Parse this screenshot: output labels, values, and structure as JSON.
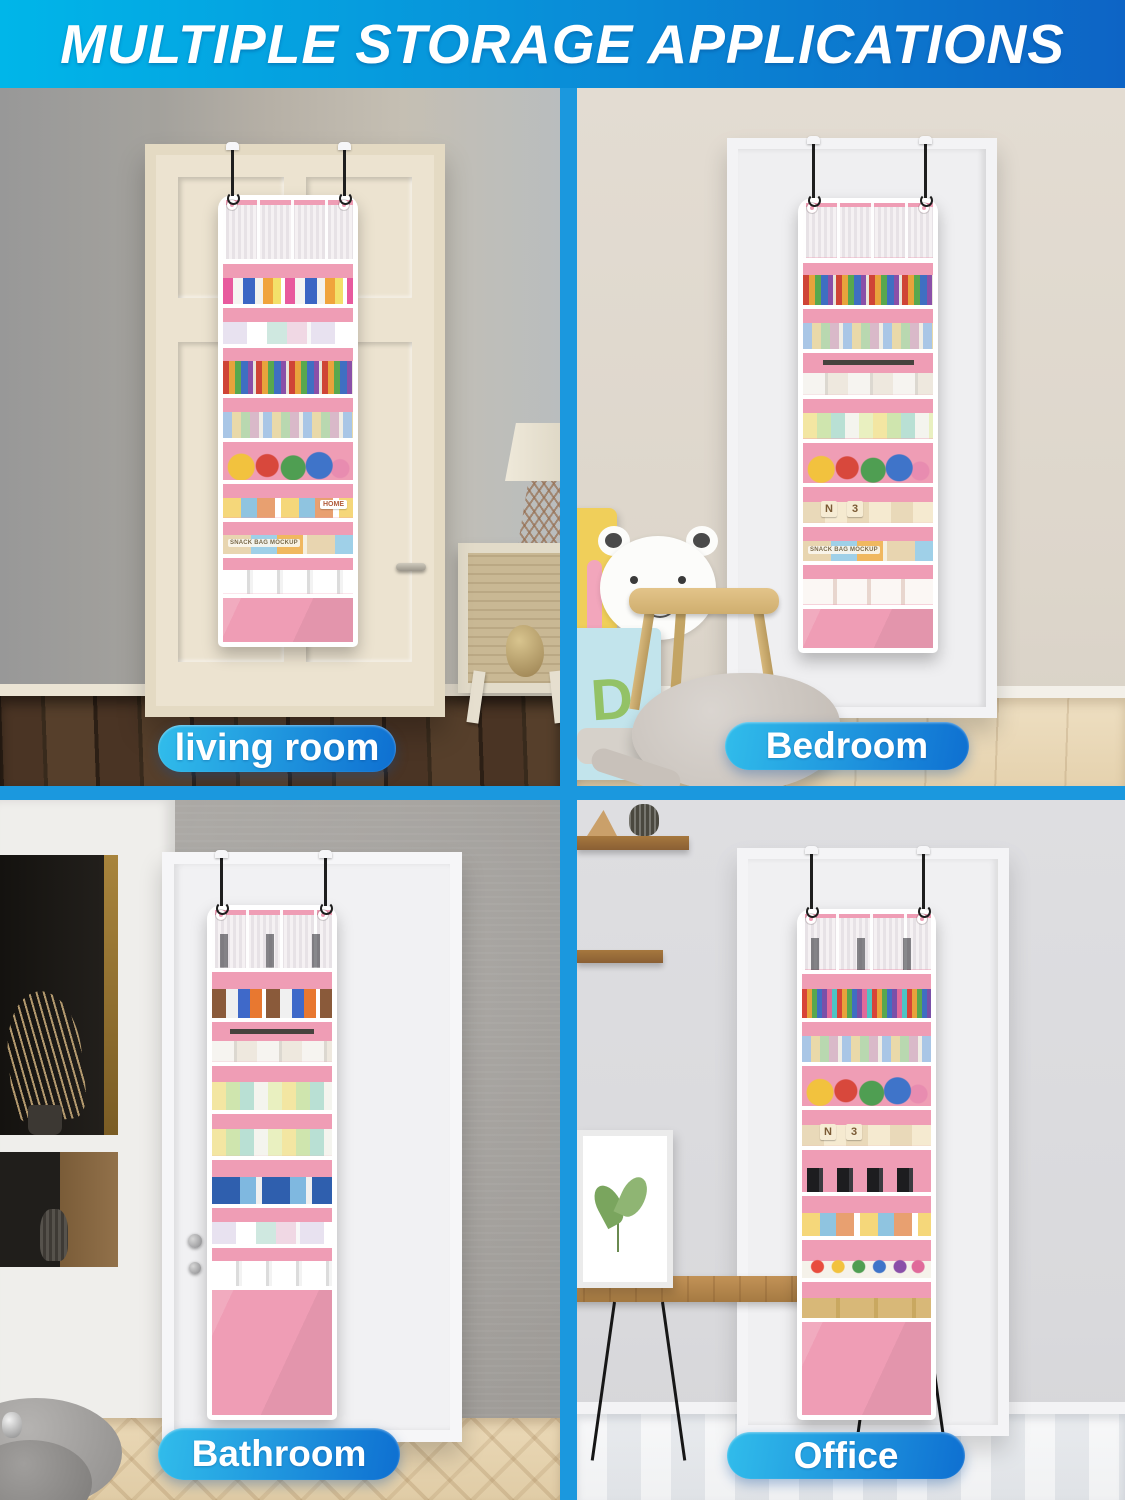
{
  "header": {
    "title": "MULTIPLE STORAGE APPLICATIONS"
  },
  "quadrants": [
    {
      "id": "living-room",
      "label": "living room"
    },
    {
      "id": "bedroom",
      "label": "Bedroom",
      "toy_block_letter": "D"
    },
    {
      "id": "bathroom",
      "label": "Bathroom"
    },
    {
      "id": "office",
      "label": "Office"
    }
  ],
  "organizer_package_labels": {
    "snack_bag": "SNACK BAG MOCKUP",
    "home_box": "HOME"
  },
  "toy_block_letters": [
    "N",
    "3"
  ],
  "theme": {
    "css_vars": {
      "divider": "#1b98de",
      "header-g1": "#00b6e9",
      "header-g2": "#0d64c5",
      "pill1": "#31bdeb",
      "pill2": "#0e6fd1",
      "pink": "#ef9db5"
    }
  }
}
